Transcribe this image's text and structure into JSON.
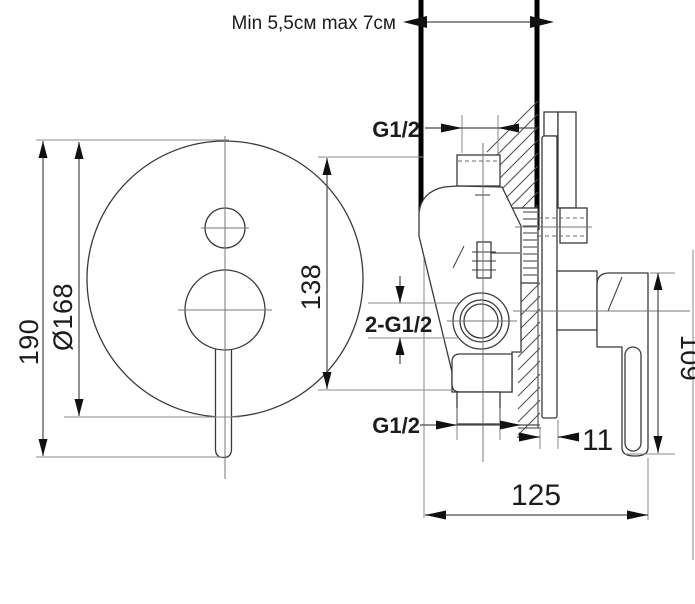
{
  "drawing": {
    "wall_note": "Min 5,5см max 7см",
    "front_view": {
      "dim_total_height": "190",
      "dim_plate_diameter": "Ø168",
      "dim_ports_span": "138"
    },
    "side_view": {
      "thread_top": "G1/2",
      "thread_inlets": "2-G1/2",
      "thread_bottom": "G1/2",
      "dim_handle_length": "109",
      "dim_plate_offset": "11",
      "dim_total_depth": "125"
    },
    "colors": {
      "line": "#3a3a3a",
      "thick_wall_line": "#000000",
      "dimension": "#8a8a8a",
      "text": "#1c1c1c",
      "background": "#ffffff"
    }
  }
}
